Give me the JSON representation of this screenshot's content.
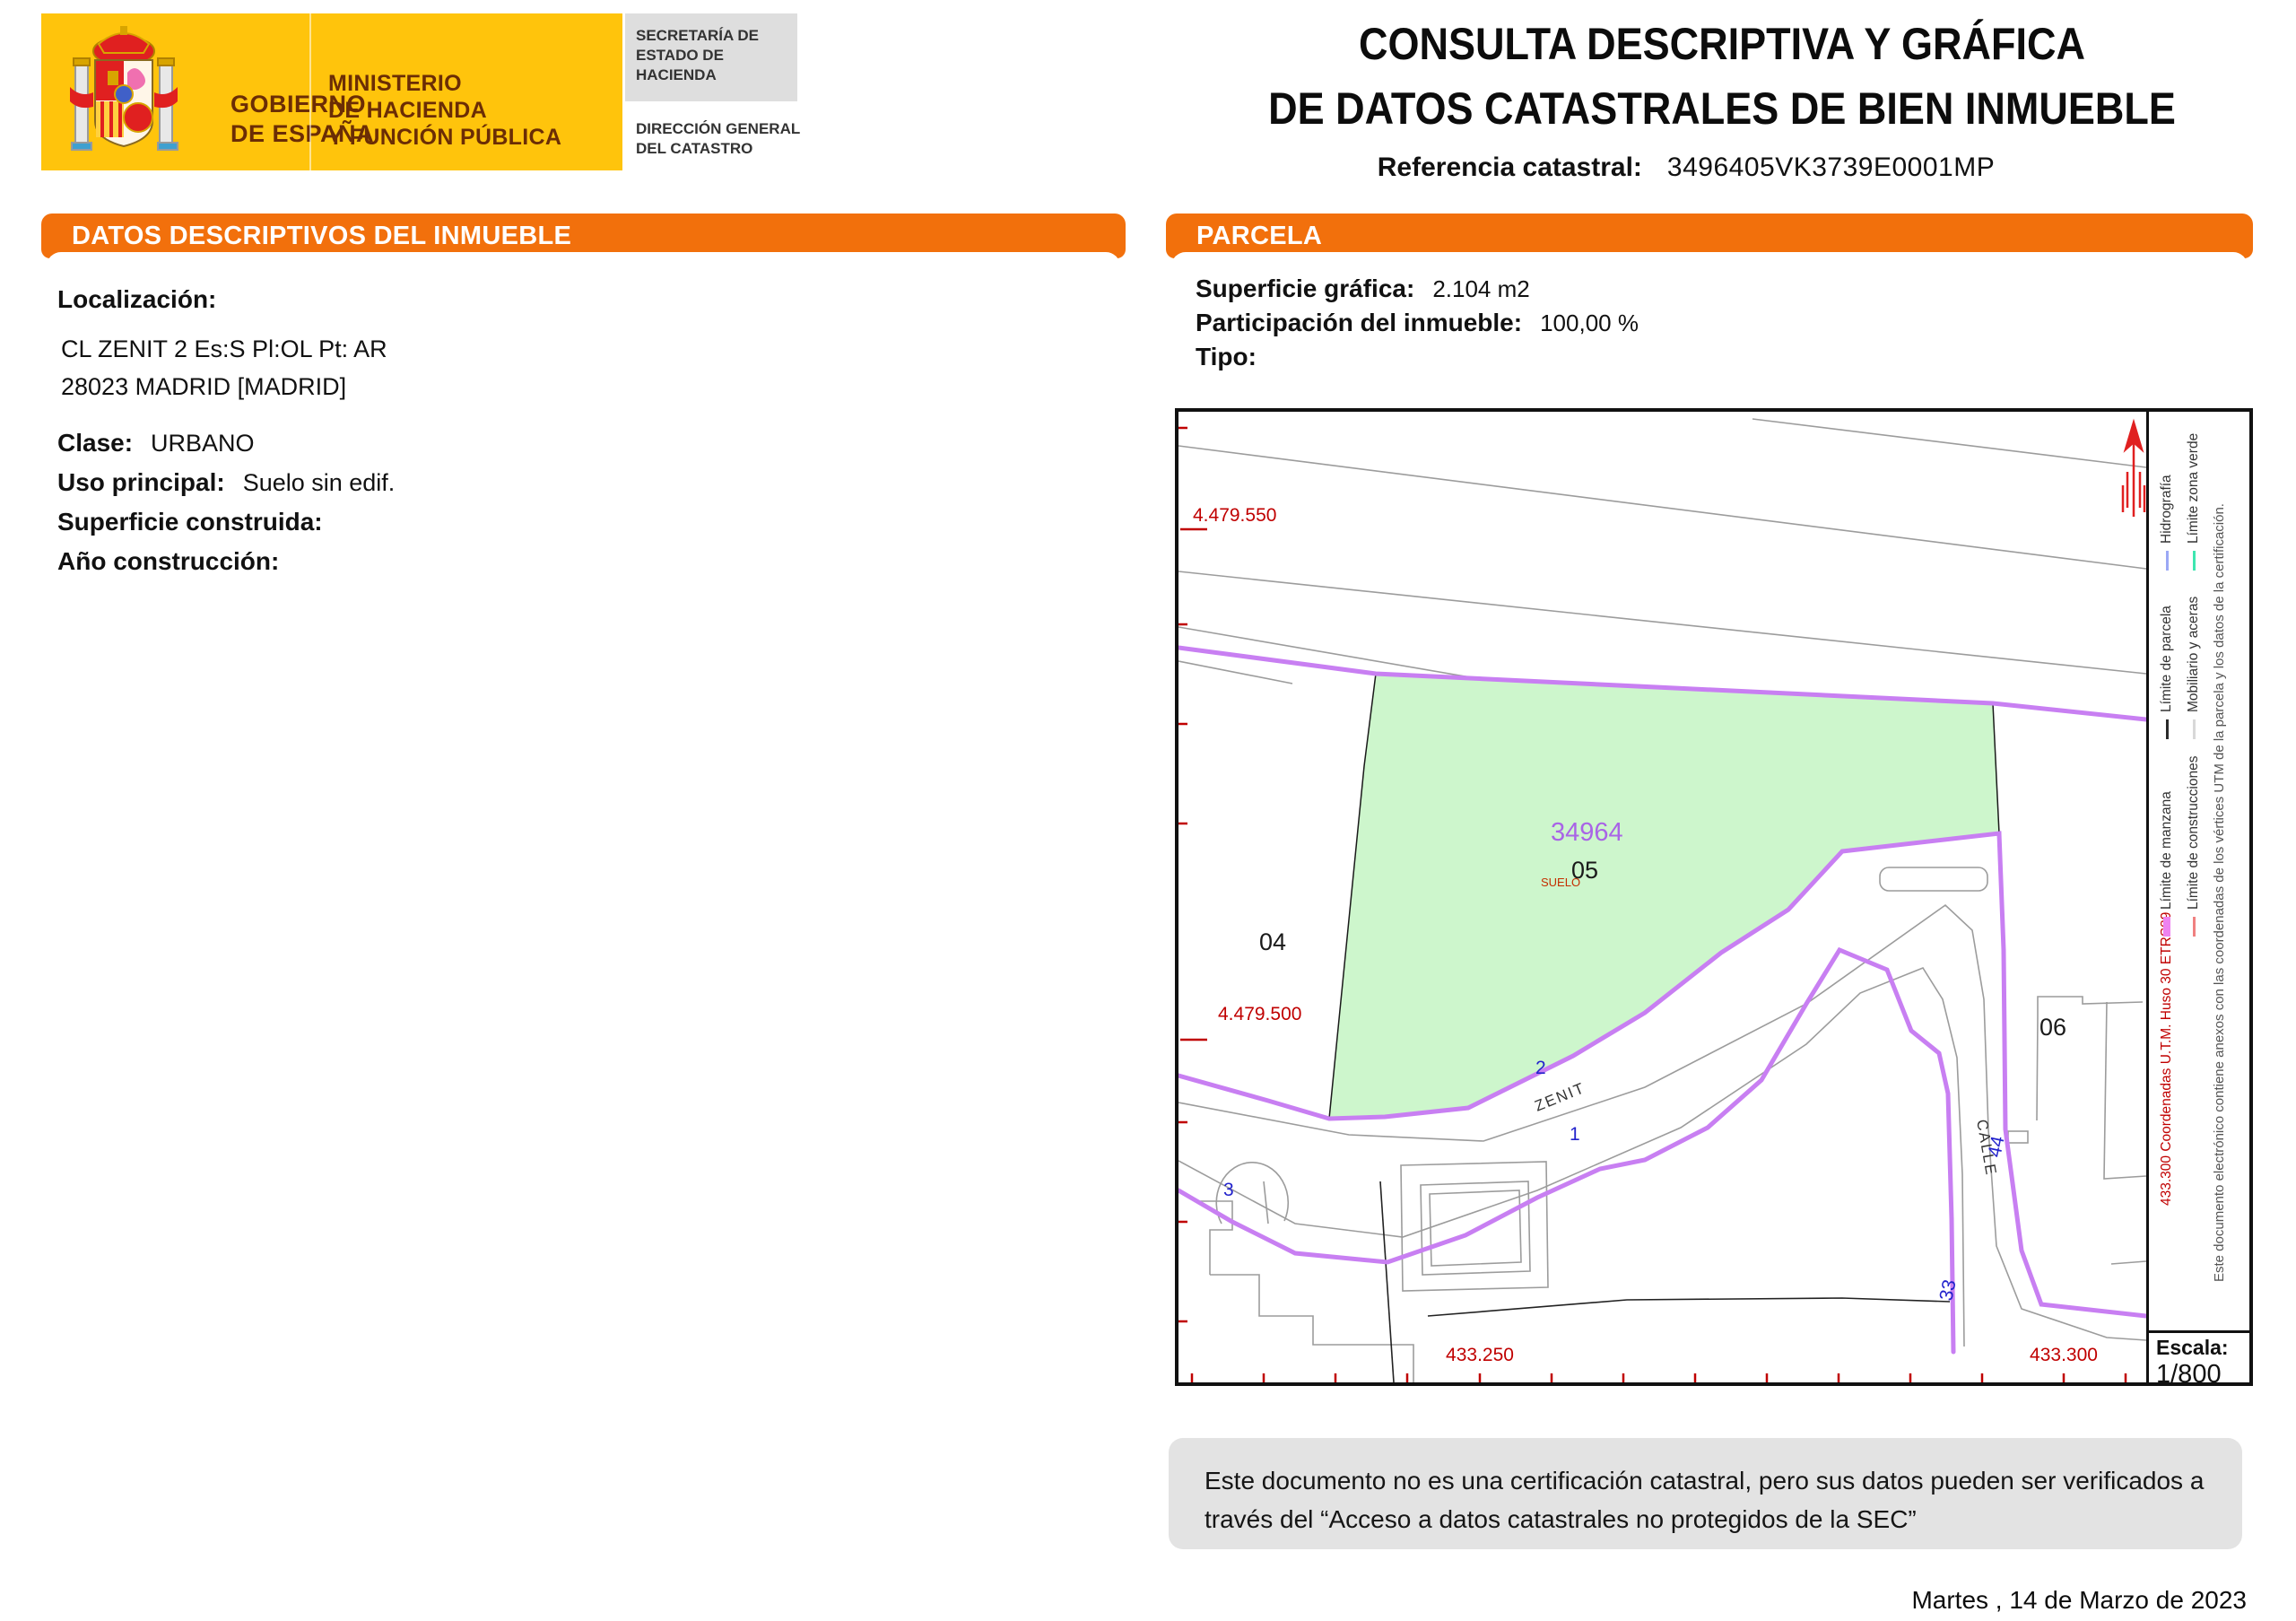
{
  "header": {
    "gobierno_line1": "GOBIERNO",
    "gobierno_line2": "DE ESPAÑA",
    "ministerio_line1": "MINISTERIO",
    "ministerio_line2": "DE HACIENDA",
    "ministerio_line3": "Y FUNCIÓN PÚBLICA",
    "secretaria": "SECRETARÍA DE ESTADO DE HACIENDA",
    "direccion": "DIRECCIÓN GENERAL DEL CATASTRO",
    "title_line1": "CONSULTA DESCRIPTIVA Y GRÁFICA",
    "title_line2": "DE DATOS CATASTRALES DE BIEN INMUEBLE",
    "ref_label": "Referencia catastral:",
    "ref_value": "3496405VK3739E0001MP"
  },
  "inmueble": {
    "section_title": "DATOS DESCRIPTIVOS DEL INMUEBLE",
    "localizacion_label": "Localización:",
    "address_line1": "CL ZENIT 2 Es:S Pl:OL Pt: AR",
    "address_line2": "28023 MADRID [MADRID]",
    "clase_label": "Clase:",
    "clase_value": "URBANO",
    "uso_label": "Uso principal:",
    "uso_value": "Suelo sin edif.",
    "superficie_label": "Superficie construida:",
    "superficie_value": "",
    "anio_label": "Año construcción:",
    "anio_value": ""
  },
  "parcela": {
    "section_title": "PARCELA",
    "superficie_label": "Superficie gráfica:",
    "superficie_value": "2.104 m2",
    "participacion_label": "Participación del inmueble:",
    "participacion_value": "100,00 %",
    "tipo_label": "Tipo:",
    "tipo_value": ""
  },
  "map": {
    "parcel_number": "34964",
    "parcel_inner_number": "05",
    "parcel_use": "SUELO",
    "neighbor_left": "04",
    "neighbor_right": "06",
    "street_zenit": "ZENIT",
    "street_calle": "CALLE",
    "portal_2": "2",
    "portal_1": "1",
    "portal_3": "3",
    "portal_44": "44",
    "portal_33": "33",
    "coord_y_top": "4.479.550",
    "coord_y_bottom": "4.479.500",
    "coord_x_left": "433.250",
    "coord_x_right": "433.300",
    "escala_label": "Escala:",
    "escala_value": "1/800",
    "legend": {
      "items": [
        {
          "name": "limite-parcela",
          "label": "Límite de parcela",
          "color": "#2a2a2a"
        },
        {
          "name": "hidrografia",
          "label": "Hidrografía",
          "color": "#9BA8F5"
        },
        {
          "name": "mobiliario-aceras",
          "label": "Mobiliario y aceras",
          "color": "#D8D8D8"
        },
        {
          "name": "limite-zona-verde",
          "label": "Límite zona verde",
          "color": "#3EE6B0"
        },
        {
          "name": "limite-manzana",
          "label": "Límite de manzana",
          "color": "#EE82F0"
        },
        {
          "name": "limite-construcciones",
          "label": "Límite de construcciones",
          "color": "#F08080"
        }
      ],
      "coord_note": "433.300 Coordenadas U.T.M. Huso 30 ETRS89",
      "annex_note": "Este documento electrónico contiene anexos con las coordenadas de los vértices UTM de la parcela y los datos de la certificación."
    },
    "colors": {
      "parcel_fill": "#CDF6CC",
      "manzana_line": "#C87FF2",
      "coordinate_text": "#C00000",
      "portal_text": "#2222CC",
      "parcel_number_text": "#A964E6"
    }
  },
  "footer": {
    "disclaimer_line1": "Este documento no es una certificación catastral, pero sus datos pueden ser verificados a",
    "disclaimer_line2": "través del “Acceso a datos catastrales no protegidos de la SEC”",
    "date": "Martes , 14 de Marzo de 2023"
  },
  "theme": {
    "accent_orange": "#F2700C",
    "logo_yellow": "#FFC40C"
  }
}
